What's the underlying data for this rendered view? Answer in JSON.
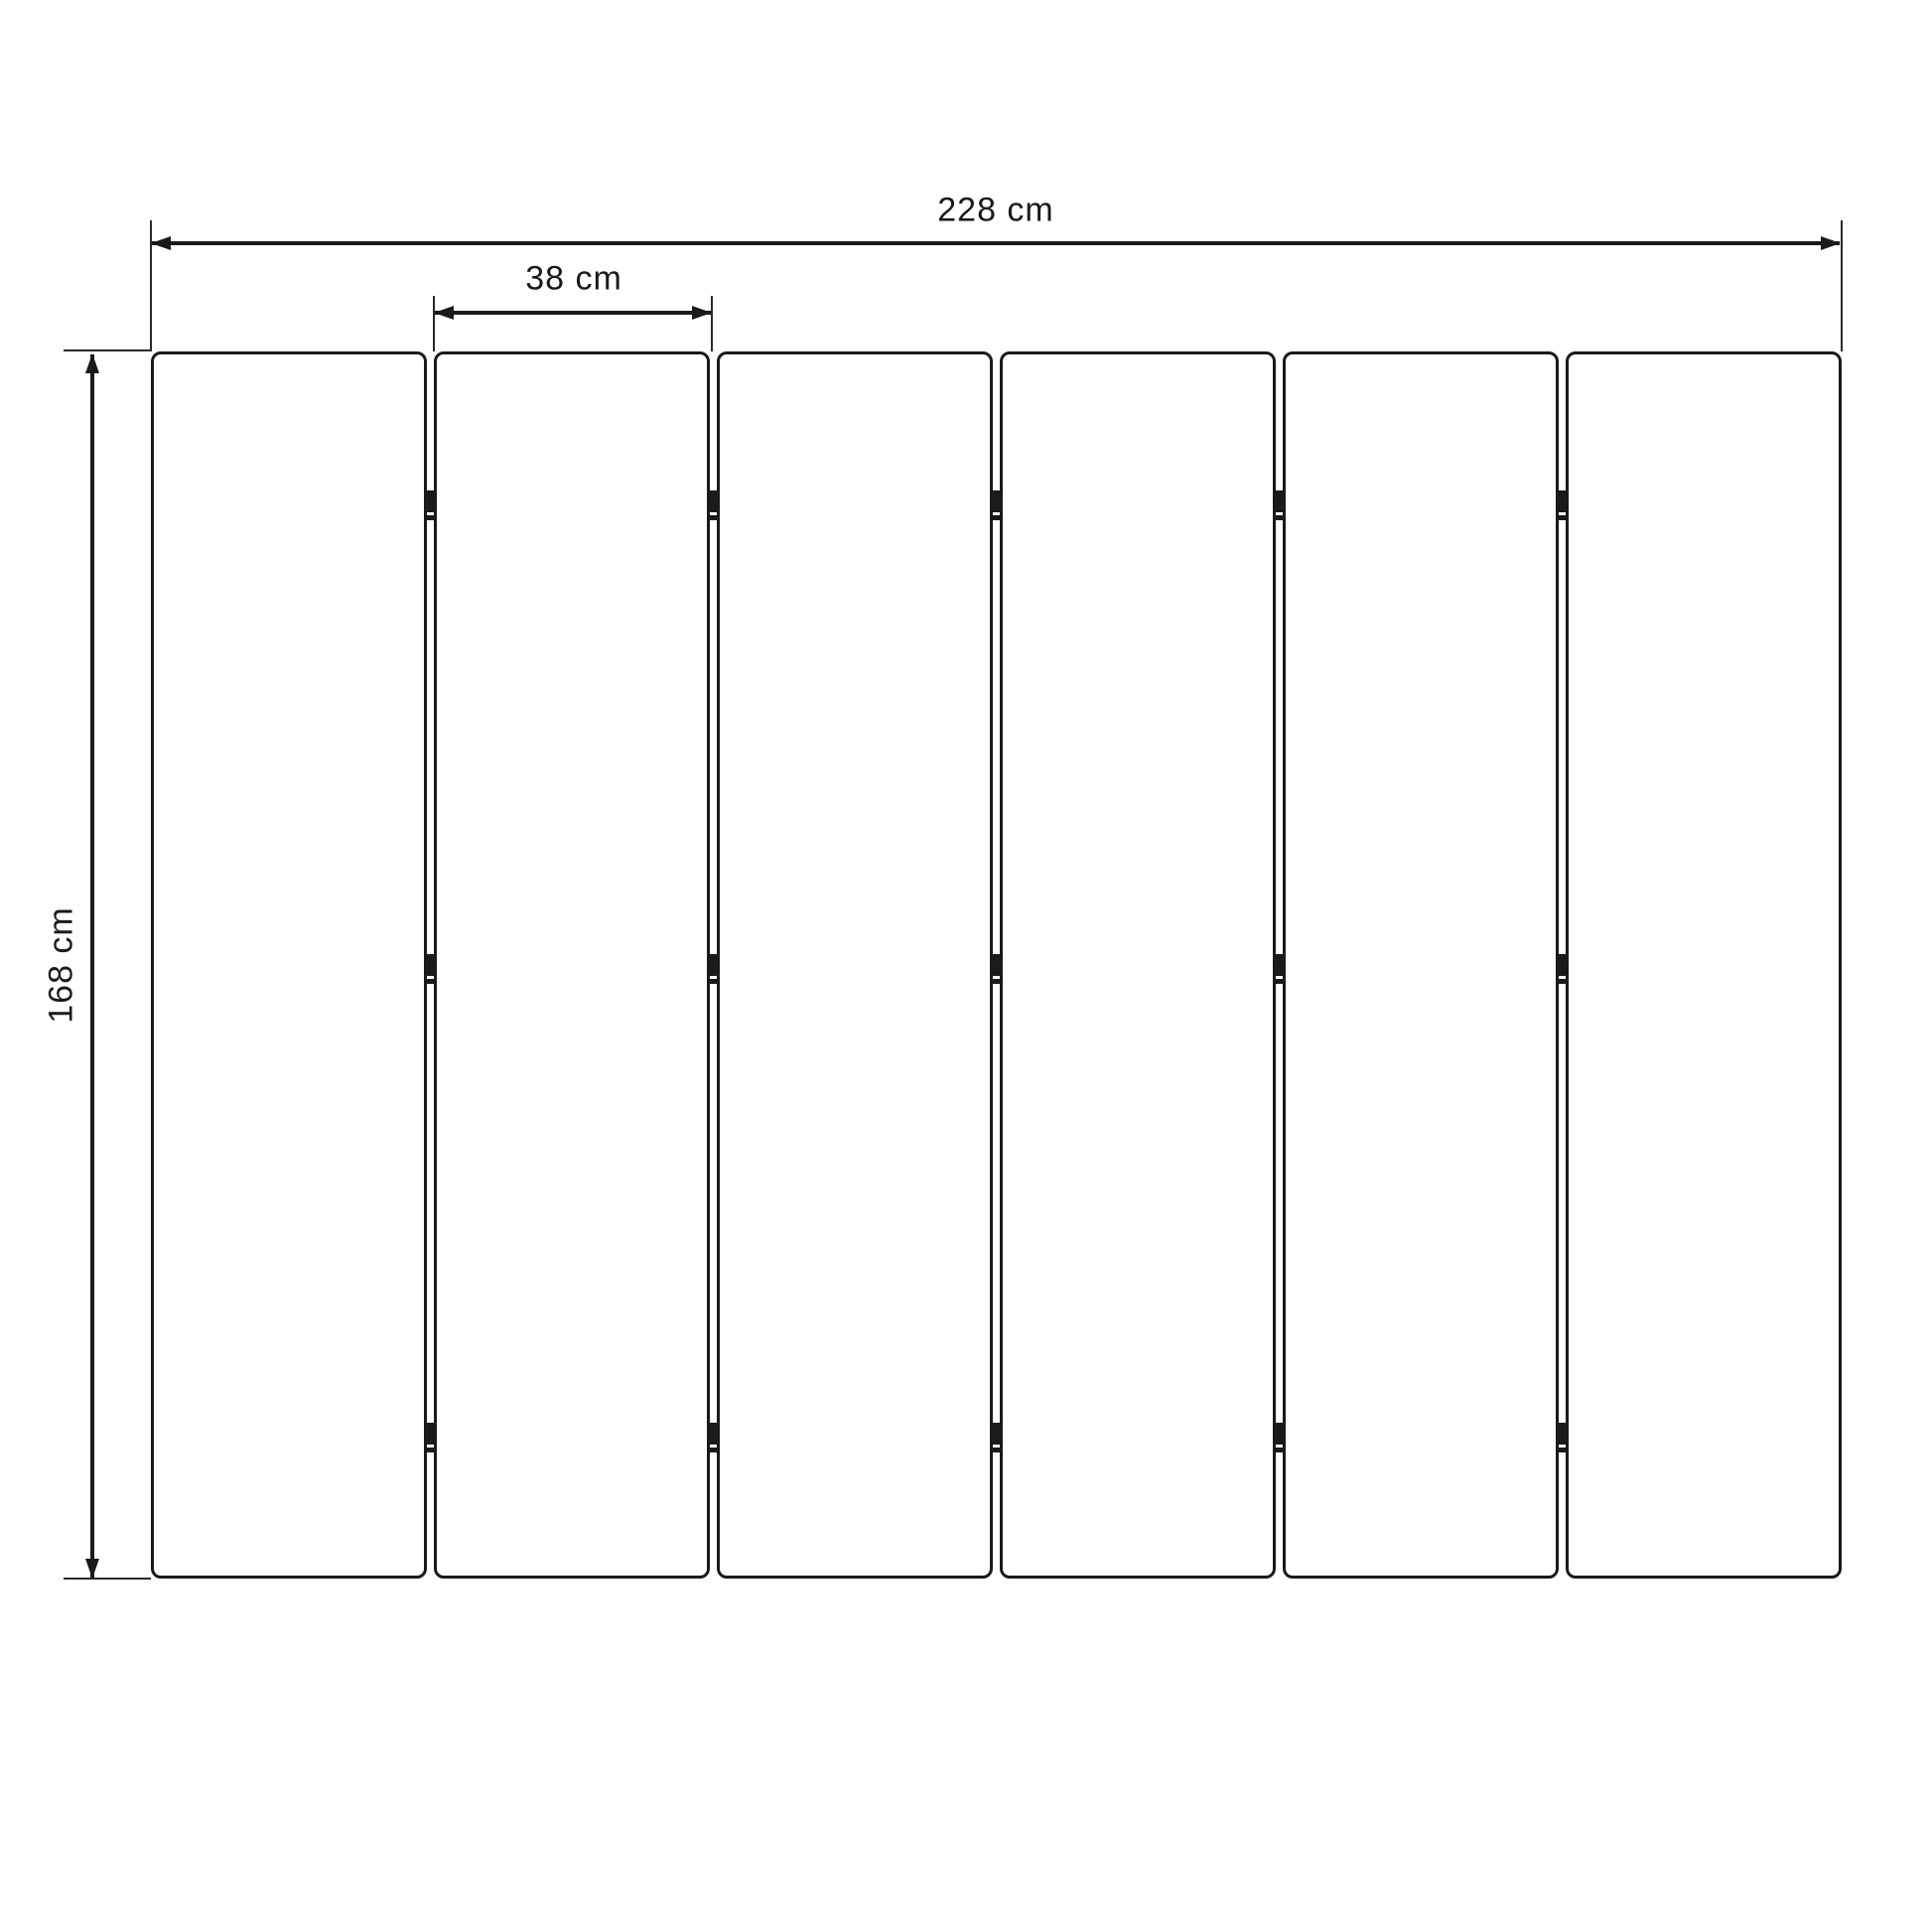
{
  "diagram": {
    "type": "dimension-drawing",
    "subject": "six-panel folding screen front view"
  },
  "labels": {
    "total_width": "228 cm",
    "panel_width": "38 cm",
    "height": "168 cm"
  },
  "panels": {
    "count": 6
  },
  "hinges": {
    "joints": 5,
    "per_joint": 3
  },
  "colors": {
    "ink": "#1a1a1a",
    "extension_line": "#2a2a2a",
    "background": "#ffffff"
  }
}
